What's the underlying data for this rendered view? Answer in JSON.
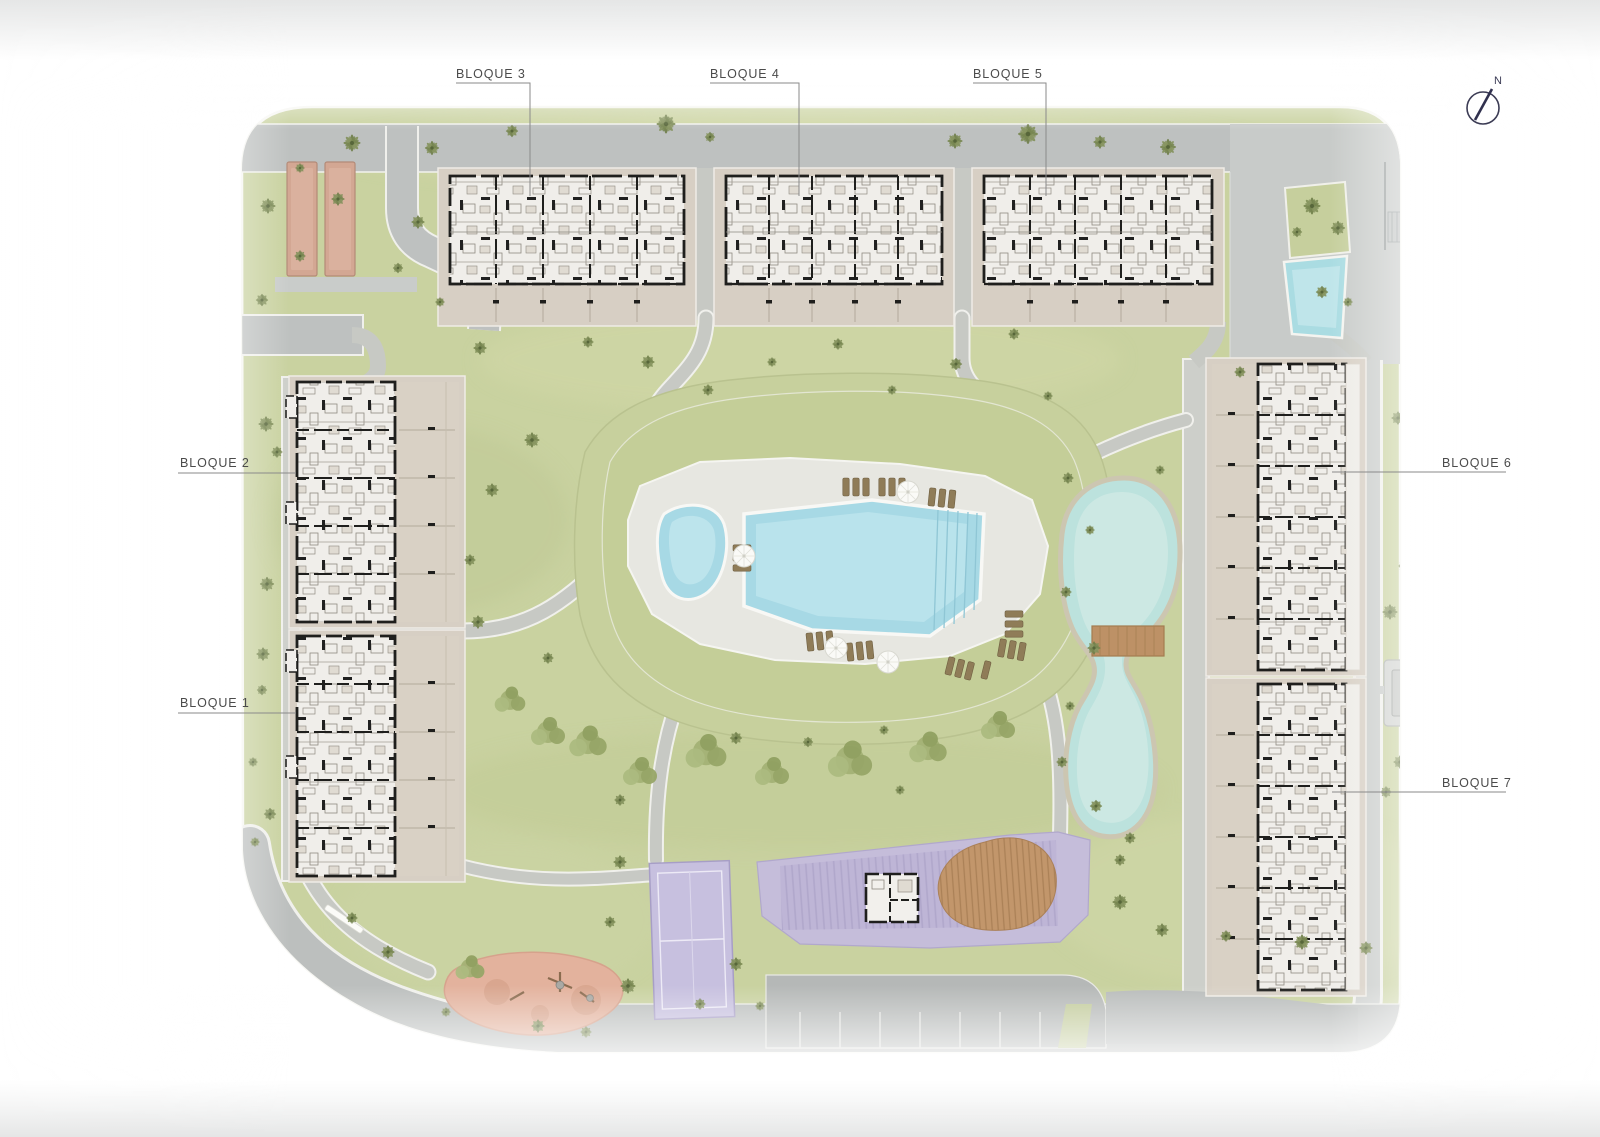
{
  "plan": {
    "block_labels": [
      {
        "id": "bloque-1",
        "label": "BLOQUE 1"
      },
      {
        "id": "bloque-2",
        "label": "BLOQUE 2"
      },
      {
        "id": "bloque-3",
        "label": "BLOQUE 3"
      },
      {
        "id": "bloque-4",
        "label": "BLOQUE 4"
      },
      {
        "id": "bloque-5",
        "label": "BLOQUE 5"
      },
      {
        "id": "bloque-6",
        "label": "BLOQUE 6"
      },
      {
        "id": "bloque-7",
        "label": "BLOQUE 7"
      }
    ],
    "north_label": "N",
    "colors": {
      "grass": "#c9d2a0",
      "road": "#bec1c0",
      "path": "#c7c9c4",
      "building_floor": "#f0eeea",
      "building_wall": "#1f1f1d",
      "terrace": "#d8d0c5",
      "pool_water": "#a7d9e5",
      "lake_water": "#bce2dd",
      "amenity_purple": "#c5bdda",
      "wood_deck": "#c2966b",
      "playground": "#e3b29d",
      "court_rect": "#d3a793",
      "label_text": "#4b4b4b"
    }
  }
}
